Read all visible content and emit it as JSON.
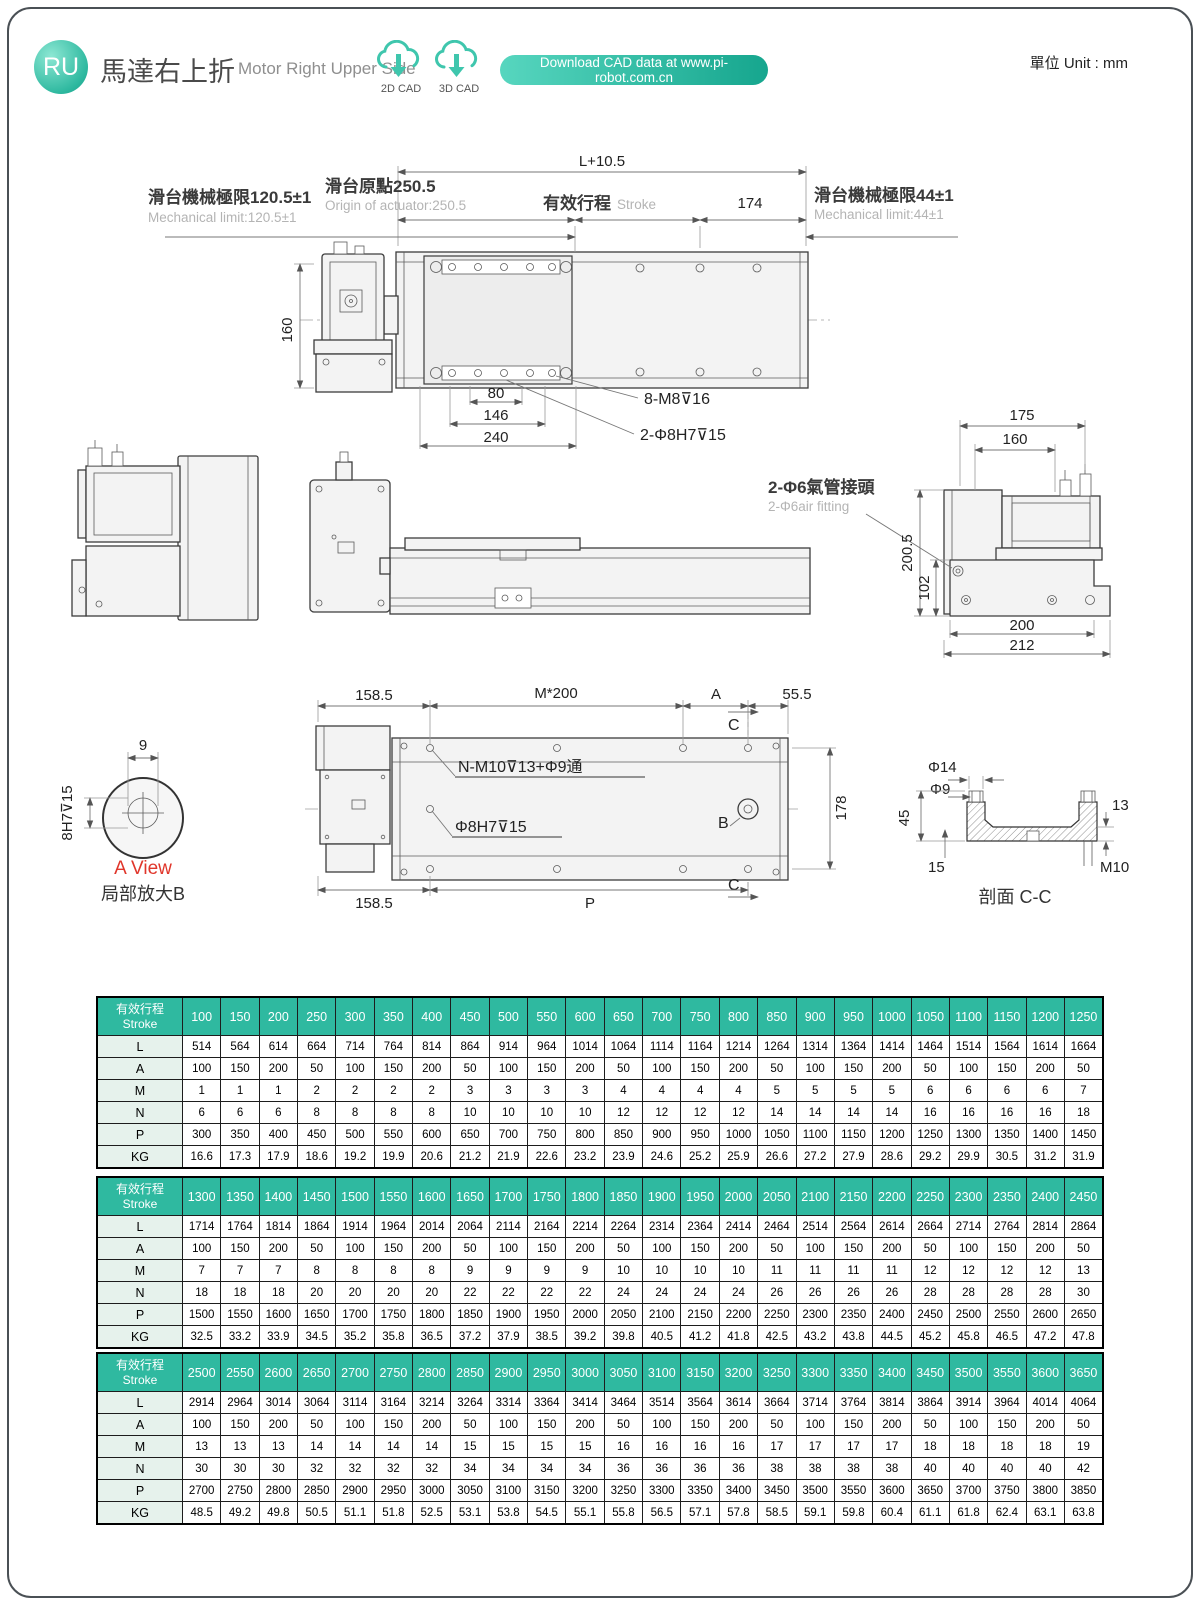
{
  "colors": {
    "accent": "#2fb9a0"
  },
  "header": {
    "badge": "RU",
    "title_zh": "馬達右上折",
    "title_en": "Motor Right Upper Side",
    "cad_2d": "2D CAD",
    "cad_3d": "3D CAD",
    "download_label": "Download CAD data at www.pi-robot.com.cn",
    "unit_label": "單位 Unit : mm"
  },
  "dims": {
    "top_total": "L+10.5",
    "origin_zh": "滑台原點250.5",
    "origin_en": "Origin of actuator:250.5",
    "limit_left_zh": "滑台機械極限120.5±1",
    "limit_left_en": "Mechanical limit:120.5±1",
    "stroke_zh": "有效行程",
    "stroke_en": "Stroke",
    "d174": "174",
    "limit_right_zh": "滑台機械極限44±1",
    "limit_right_en": "Mechanical limit:44±1",
    "d160v": "160",
    "d80": "80",
    "d146": "146",
    "d240": "240",
    "m8": "8-M8⊽16",
    "phi8_2": "2-Φ8H7⊽15",
    "air_zh": "2-Φ6氣管接頭",
    "air_en": "2-Φ6air fitting",
    "d175": "175",
    "d160s": "160",
    "d200_5": "200.5",
    "d102": "102",
    "d200": "200",
    "d212": "212",
    "d158_5a": "158.5",
    "m200": "M*200",
    "A": "A",
    "d55_5": "55.5",
    "C_top": "C",
    "C_bot": "C",
    "B": "B",
    "nm10": "N-M10⊽13+Φ9通",
    "phi8h7": "Φ8H7⊽15",
    "d178": "178",
    "d158_5b": "158.5",
    "P": "P",
    "d9": "9",
    "h8h7": "8H7⊽15",
    "a_view": "A View",
    "a_view_sub": "局部放大B",
    "phi14": "Φ14",
    "phi9": "Φ9",
    "d45": "45",
    "d15": "15",
    "d13": "13",
    "m10": "M10",
    "section": "剖面 C-C"
  },
  "table_meta": {
    "header_zh": "有效行程",
    "header_en": "Stroke",
    "row_labels": [
      "L",
      "A",
      "M",
      "N",
      "P",
      "KG"
    ]
  },
  "tables": [
    {
      "strokes": [
        100,
        150,
        200,
        250,
        300,
        350,
        400,
        450,
        500,
        550,
        600,
        650,
        700,
        750,
        800,
        850,
        900,
        950,
        1000,
        1050,
        1100,
        1150,
        1200,
        1250
      ],
      "rows": {
        "L": [
          514,
          564,
          614,
          664,
          714,
          764,
          814,
          864,
          914,
          964,
          1014,
          1064,
          1114,
          1164,
          1214,
          1264,
          1314,
          1364,
          1414,
          1464,
          1514,
          1564,
          1614,
          1664
        ],
        "A": [
          100,
          150,
          200,
          50,
          100,
          150,
          200,
          50,
          100,
          150,
          200,
          50,
          100,
          150,
          200,
          50,
          100,
          150,
          200,
          50,
          100,
          150,
          200,
          50
        ],
        "M": [
          1,
          1,
          1,
          2,
          2,
          2,
          2,
          3,
          3,
          3,
          3,
          4,
          4,
          4,
          4,
          5,
          5,
          5,
          5,
          6,
          6,
          6,
          6,
          7
        ],
        "N": [
          6,
          6,
          6,
          8,
          8,
          8,
          8,
          10,
          10,
          10,
          10,
          12,
          12,
          12,
          12,
          14,
          14,
          14,
          14,
          16,
          16,
          16,
          16,
          18
        ],
        "P": [
          300,
          350,
          400,
          450,
          500,
          550,
          600,
          650,
          700,
          750,
          800,
          850,
          900,
          950,
          1000,
          1050,
          1100,
          1150,
          1200,
          1250,
          1300,
          1350,
          1400,
          1450
        ],
        "KG": [
          16.6,
          17.3,
          17.9,
          18.6,
          19.2,
          19.9,
          20.6,
          21.2,
          21.9,
          22.6,
          23.2,
          23.9,
          24.6,
          25.2,
          25.9,
          26.6,
          27.2,
          27.9,
          28.6,
          29.2,
          29.9,
          30.5,
          31.2,
          31.9
        ]
      }
    },
    {
      "strokes": [
        1300,
        1350,
        1400,
        1450,
        1500,
        1550,
        1600,
        1650,
        1700,
        1750,
        1800,
        1850,
        1900,
        1950,
        2000,
        2050,
        2100,
        2150,
        2200,
        2250,
        2300,
        2350,
        2400,
        2450
      ],
      "rows": {
        "L": [
          1714,
          1764,
          1814,
          1864,
          1914,
          1964,
          2014,
          2064,
          2114,
          2164,
          2214,
          2264,
          2314,
          2364,
          2414,
          2464,
          2514,
          2564,
          2614,
          2664,
          2714,
          2764,
          2814,
          2864
        ],
        "A": [
          100,
          150,
          200,
          50,
          100,
          150,
          200,
          50,
          100,
          150,
          200,
          50,
          100,
          150,
          200,
          50,
          100,
          150,
          200,
          50,
          100,
          150,
          200,
          50
        ],
        "M": [
          7,
          7,
          7,
          8,
          8,
          8,
          8,
          9,
          9,
          9,
          9,
          10,
          10,
          10,
          10,
          11,
          11,
          11,
          11,
          12,
          12,
          12,
          12,
          13
        ],
        "N": [
          18,
          18,
          18,
          20,
          20,
          20,
          20,
          22,
          22,
          22,
          22,
          24,
          24,
          24,
          24,
          26,
          26,
          26,
          26,
          28,
          28,
          28,
          28,
          30
        ],
        "P": [
          1500,
          1550,
          1600,
          1650,
          1700,
          1750,
          1800,
          1850,
          1900,
          1950,
          2000,
          2050,
          2100,
          2150,
          2200,
          2250,
          2300,
          2350,
          2400,
          2450,
          2500,
          2550,
          2600,
          2650
        ],
        "KG": [
          32.5,
          33.2,
          33.9,
          34.5,
          35.2,
          35.8,
          36.5,
          37.2,
          37.9,
          38.5,
          39.2,
          39.8,
          40.5,
          41.2,
          41.8,
          42.5,
          43.2,
          43.8,
          44.5,
          45.2,
          45.8,
          46.5,
          47.2,
          47.8
        ]
      }
    },
    {
      "strokes": [
        2500,
        2550,
        2600,
        2650,
        2700,
        2750,
        2800,
        2850,
        2900,
        2950,
        3000,
        3050,
        3100,
        3150,
        3200,
        3250,
        3300,
        3350,
        3400,
        3450,
        3500,
        3550,
        3600,
        3650
      ],
      "rows": {
        "L": [
          2914,
          2964,
          3014,
          3064,
          3114,
          3164,
          3214,
          3264,
          3314,
          3364,
          3414,
          3464,
          3514,
          3564,
          3614,
          3664,
          3714,
          3764,
          3814,
          3864,
          3914,
          3964,
          4014,
          4064
        ],
        "A": [
          100,
          150,
          200,
          50,
          100,
          150,
          200,
          50,
          100,
          150,
          200,
          50,
          100,
          150,
          200,
          50,
          100,
          150,
          200,
          50,
          100,
          150,
          200,
          50
        ],
        "M": [
          13,
          13,
          13,
          14,
          14,
          14,
          14,
          15,
          15,
          15,
          15,
          16,
          16,
          16,
          16,
          17,
          17,
          17,
          17,
          18,
          18,
          18,
          18,
          19
        ],
        "N": [
          30,
          30,
          30,
          32,
          32,
          32,
          32,
          34,
          34,
          34,
          34,
          36,
          36,
          36,
          36,
          38,
          38,
          38,
          38,
          40,
          40,
          40,
          40,
          42
        ],
        "P": [
          2700,
          2750,
          2800,
          2850,
          2900,
          2950,
          3000,
          3050,
          3100,
          3150,
          3200,
          3250,
          3300,
          3350,
          3400,
          3450,
          3500,
          3550,
          3600,
          3650,
          3700,
          3750,
          3800,
          3850
        ],
        "KG": [
          48.5,
          49.2,
          49.8,
          50.5,
          51.1,
          51.8,
          52.5,
          53.1,
          53.8,
          54.5,
          55.1,
          55.8,
          56.5,
          57.1,
          57.8,
          58.5,
          59.1,
          59.8,
          60.4,
          61.1,
          61.8,
          62.4,
          63.1,
          63.8
        ]
      }
    }
  ]
}
